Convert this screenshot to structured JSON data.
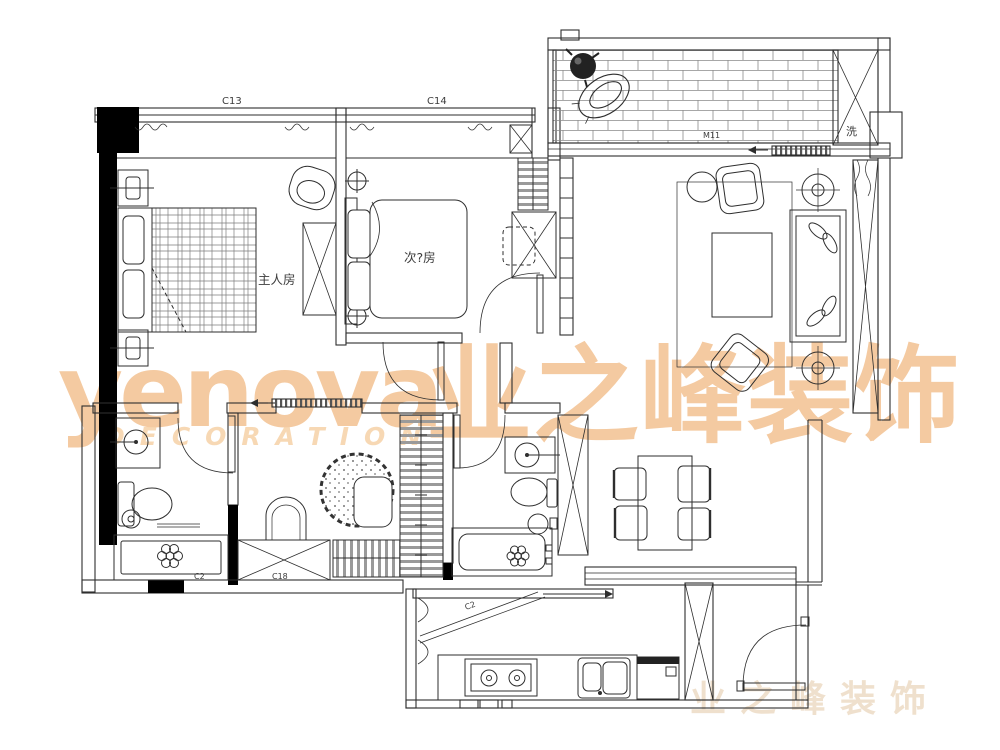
{
  "plan": {
    "rooms": {
      "master_bedroom": "主人房",
      "second_bedroom": "次?房",
      "laundry": "洗"
    },
    "labels": {
      "window_c13": "C13",
      "window_c14": "C14",
      "door_m11": "M11",
      "window_c2": "C2",
      "window_c18": "C18",
      "kitchen_door": "C2"
    }
  },
  "watermark": {
    "brand": "yenova",
    "tagline": "DECORATION",
    "brand_cn": "业之峰装饰",
    "brand_cn_faint": "业之峰装饰",
    "accent_color": "#f2bf8d"
  },
  "colors": {
    "background": "#ffffff",
    "line": "#2e2e2e",
    "wall_fill": "#000000",
    "watermark": "#f2bf8d"
  }
}
